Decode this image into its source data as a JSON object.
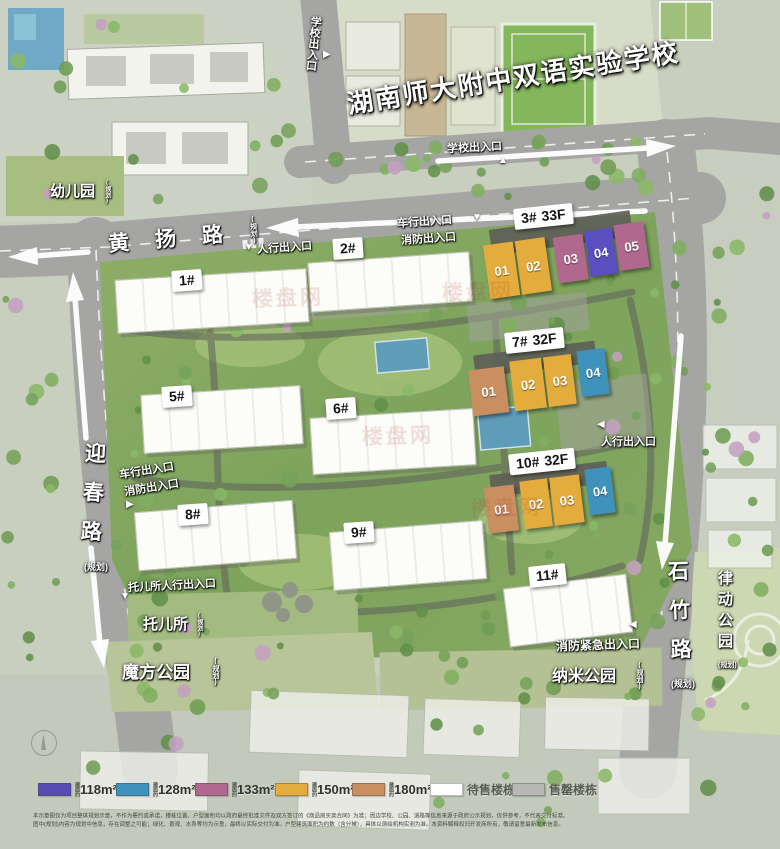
{
  "school": {
    "name": "湖南师大附中双语实验学校",
    "gate_south": "学校出入口",
    "gate_west": "学校出入口"
  },
  "roads": {
    "huangyang": {
      "name": "黄扬路",
      "tag": "(规划)"
    },
    "yingchun": {
      "name": "迎春路",
      "tag": "(规划)"
    },
    "shizhu": {
      "name": "石竹路",
      "tag": "(规划)"
    }
  },
  "areas": {
    "kindergarten": {
      "name": "幼儿园",
      "tag": "(规划)"
    },
    "nursery": {
      "name": "托儿所",
      "tag": "(规划)"
    },
    "mofang_park": {
      "name": "魔方公园",
      "tag": "(规划)"
    },
    "nami_park": {
      "name": "纳米公园",
      "tag": "(规划)"
    },
    "lvdong_park": {
      "name": "律动公园",
      "tag": "(规划)"
    }
  },
  "entrances": {
    "ped_north": "人行出入口",
    "vehicle_north_line1": "车行出入口",
    "vehicle_north_line2": "消防出入口",
    "vehicle_west_line1": "车行出入口",
    "vehicle_west_line2": "消防出入口",
    "nursery_ped": "托儿所人行出入口",
    "ped_east": "人行出入口",
    "fire_emergency": "消防紧急出入口"
  },
  "icons": {
    "triangle_down": "▼",
    "triangle_up": "▲",
    "triangle_left": "◀",
    "triangle_right": "▶"
  },
  "buildings": {
    "b1": {
      "label": "1#"
    },
    "b2": {
      "label": "2#"
    },
    "b3": {
      "label": "3#",
      "floors": "33F",
      "units": [
        {
          "no": "01",
          "color": "#e3ac3c"
        },
        {
          "no": "02",
          "color": "#e3ac3c"
        },
        {
          "no": "03",
          "color": "#b0688e"
        },
        {
          "no": "04",
          "color": "#5a4fc0"
        },
        {
          "no": "05",
          "color": "#b0688e"
        }
      ]
    },
    "b5": {
      "label": "5#"
    },
    "b6": {
      "label": "6#"
    },
    "b7": {
      "label": "7#",
      "floors": "32F",
      "units": [
        {
          "no": "01",
          "color": "#c98f60"
        },
        {
          "no": "02",
          "color": "#e3ac3c"
        },
        {
          "no": "03",
          "color": "#e3ac3c"
        },
        {
          "no": "04",
          "color": "#3e92bb"
        }
      ]
    },
    "b8": {
      "label": "8#"
    },
    "b9": {
      "label": "9#"
    },
    "b10": {
      "label": "10#",
      "floors": "32F",
      "units": [
        {
          "no": "01",
          "color": "#c98f60"
        },
        {
          "no": "02",
          "color": "#e3ac3c"
        },
        {
          "no": "03",
          "color": "#e3ac3c"
        },
        {
          "no": "04",
          "color": "#3e92bb"
        }
      ]
    },
    "b11": {
      "label": "11#"
    }
  },
  "legend": {
    "prefix": "建面约",
    "items": [
      {
        "label": "118m²",
        "color": "#564cb4"
      },
      {
        "label": "128m²",
        "color": "#3e92bb"
      },
      {
        "label": "133m²",
        "color": "#b0688e"
      },
      {
        "label": "150m²",
        "color": "#e3ac3c"
      },
      {
        "label": "180m²",
        "color": "#c98f60"
      },
      {
        "label": "待售楼栋",
        "color": "#ffffff"
      },
      {
        "label": "售罄楼栋",
        "color": "#b8b8b6"
      }
    ]
  },
  "watermark": {
    "text": "楼盘网"
  },
  "disclaimer": {
    "line1": "本示意图仅为项目整体规划示意，不作为要约或承诺，楼栋位置、户型面积均以政府最终批准文件及双方签订的《商品房买卖合同》为准；周边学校、公园、道路等信息来源于政府公示规划，仅供参考，不代表交付标准。",
    "line2": "图中(规划)内容为规划中信息，存在调整之可能；绿化、景观、水系等均为示意，最终以实际交付为准。户型建筑面积为约数（含分摊），具体以测绘机构实测为准。本资料解释权归开发商所有，敬请留意最新发布信息。"
  }
}
